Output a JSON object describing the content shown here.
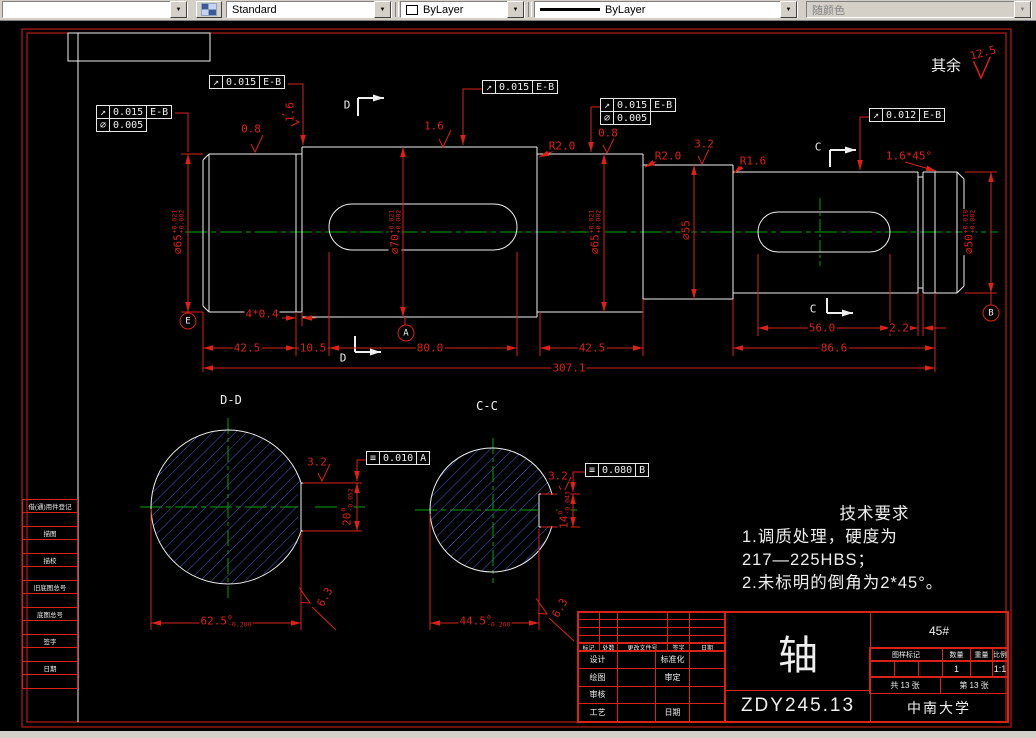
{
  "toolbar": {
    "style_value": "Standard",
    "color_value": "ByLayer",
    "linetype_value": "ByLayer",
    "plot_style_value": "随颜色"
  },
  "sheet": {
    "surface_note": "其余",
    "surface_roughness_general": "12.5",
    "tech_requirements": {
      "title": "技术要求",
      "lines": [
        "1.调质处理，硬度为",
        "217—225HBS；",
        "2.未标明的倒角为2*45°。"
      ]
    },
    "margin_fields": [
      "借(通)用件登记",
      "描图",
      "描校",
      "旧底图总号",
      "底图总号",
      "签字",
      "日期"
    ],
    "title_block": {
      "part_name": "轴",
      "drawing_no": "ZDY245.13",
      "material": "45#",
      "company": "中南大学",
      "rev_headers": [
        "标记",
        "处数",
        "更改文件号",
        "签字",
        "日期"
      ],
      "roles_left": [
        "设计",
        "绘图",
        "审核",
        "工艺"
      ],
      "roles_right": [
        "标准化",
        "审定",
        "",
        "日期"
      ],
      "stamp_headers": [
        "图样标记",
        "数量",
        "重量",
        "比例"
      ],
      "qty": "1",
      "scale": "1:1",
      "sheets_total": "共 13 张",
      "sheet_no": "第 13 张"
    }
  },
  "drawing": {
    "colors": {
      "dim": "#d92318",
      "white": "#efefef",
      "green": "#00a800",
      "hatch": "#3d5fcc"
    },
    "labels": [
      {
        "name": "section-label-dd",
        "text": "D-D",
        "x": 231,
        "y": 400,
        "c": "w",
        "size": 12
      },
      {
        "name": "section-label-cc",
        "text": "C-C",
        "x": 487,
        "y": 406,
        "c": "w",
        "size": 12
      },
      {
        "name": "surface-note",
        "text": "其余",
        "x": 946,
        "y": 66,
        "c": "w",
        "size": 15
      },
      {
        "name": "surface-value",
        "text": "12.5",
        "x": 983,
        "y": 53,
        "rot": -15
      },
      {
        "name": "cut-letter",
        "text": "D",
        "x": 347,
        "y": 105,
        "c": "w"
      },
      {
        "name": "cut-letter",
        "text": "D",
        "x": 343,
        "y": 358,
        "c": "w"
      },
      {
        "name": "cut-letter",
        "text": "C",
        "x": 818,
        "y": 147,
        "c": "w"
      },
      {
        "name": "cut-letter",
        "text": "C",
        "x": 813,
        "y": 309,
        "c": "w"
      },
      {
        "text": "42.5",
        "x": 247,
        "y": 348
      },
      {
        "text": "10.5",
        "x": 313,
        "y": 348
      },
      {
        "text": "80.0",
        "x": 430,
        "y": 348
      },
      {
        "text": "42.5",
        "x": 592,
        "y": 348
      },
      {
        "text": "86.6",
        "x": 834,
        "y": 348
      },
      {
        "text": "56.0",
        "x": 822,
        "y": 328
      },
      {
        "text": "2.2",
        "x": 899,
        "y": 328
      },
      {
        "text": "307.1",
        "x": 569,
        "y": 368
      },
      {
        "text": "4*0.4",
        "x": 262,
        "y": 314
      },
      {
        "text": "R2.0",
        "x": 562,
        "y": 146
      },
      {
        "text": "R2.0",
        "x": 668,
        "y": 156
      },
      {
        "text": "R1.6",
        "x": 753,
        "y": 161
      },
      {
        "text": "1.6*45°",
        "x": 909,
        "y": 156
      },
      {
        "text": "0.8",
        "x": 251,
        "y": 129
      },
      {
        "text": "1.6",
        "x": 290,
        "y": 112,
        "rot": -90
      },
      {
        "text": "1.6",
        "x": 434,
        "y": 126
      },
      {
        "text": "0.8",
        "x": 608,
        "y": 133
      },
      {
        "text": "3.2",
        "x": 704,
        "y": 144
      },
      {
        "text": "3.2",
        "x": 317,
        "y": 462
      },
      {
        "text": "3.2",
        "x": 558,
        "y": 476
      },
      {
        "text": "6.3",
        "x": 325,
        "y": 597,
        "rot": -60
      },
      {
        "text": "6.3",
        "x": 560,
        "y": 608,
        "rot": -60
      },
      {
        "text": "⌀65",
        "sup": "+0.021",
        "sub": "+0.002",
        "x": 178,
        "y": 232,
        "rot": -90
      },
      {
        "text": "⌀70",
        "sup": "+0.021",
        "sub": "+0.002",
        "x": 395,
        "y": 232,
        "rot": -90
      },
      {
        "text": "⌀65",
        "sup": "+0.021",
        "sub": "+0.002",
        "x": 595,
        "y": 232,
        "rot": -90
      },
      {
        "text": "⌀55",
        "x": 686,
        "y": 230,
        "rot": -90
      },
      {
        "text": "⌀50",
        "sup": "+0.018",
        "sub": "+0.002",
        "x": 969,
        "y": 232,
        "rot": -90
      },
      {
        "text": "20",
        "sup": "0",
        "sub": "-0.052",
        "x": 347,
        "y": 507,
        "rot": -90
      },
      {
        "text": "14",
        "sup": "0",
        "sub": "-0.043",
        "x": 564,
        "y": 510,
        "rot": -90
      },
      {
        "text": "62.5",
        "sup": "0",
        "sub": "-0.200",
        "x": 226,
        "y": 621
      },
      {
        "text": "44.5",
        "sup": "0",
        "sub": "-0.200",
        "x": 485,
        "y": 621
      }
    ],
    "frames": [
      {
        "x": 97,
        "y": 106,
        "rows": [
          [
            "↗",
            "0.015",
            "E-B"
          ],
          [
            "⌀",
            "0.005"
          ]
        ]
      },
      {
        "x": 210,
        "y": 76,
        "rows": [
          [
            "↗",
            "0.015",
            "E-B"
          ]
        ]
      },
      {
        "x": 483,
        "y": 81,
        "rows": [
          [
            "↗",
            "0.015",
            "E-B"
          ]
        ]
      },
      {
        "x": 601,
        "y": 99,
        "rows": [
          [
            "↗",
            "0.015",
            "E-B"
          ],
          [
            "⌀",
            "0.005"
          ]
        ]
      },
      {
        "x": 870,
        "y": 109,
        "rows": [
          [
            "↗",
            "0.012",
            "E-B"
          ]
        ]
      },
      {
        "x": 367,
        "y": 452,
        "rows": [
          [
            "≡",
            "0.010",
            "A"
          ]
        ]
      },
      {
        "x": 586,
        "y": 464,
        "rows": [
          [
            "≡",
            "0.080",
            "B"
          ]
        ]
      }
    ],
    "datums": [
      {
        "letter": "E",
        "x": 188,
        "y": 321
      },
      {
        "letter": "A",
        "x": 406,
        "y": 333
      },
      {
        "letter": "B",
        "x": 991,
        "y": 313
      }
    ]
  }
}
